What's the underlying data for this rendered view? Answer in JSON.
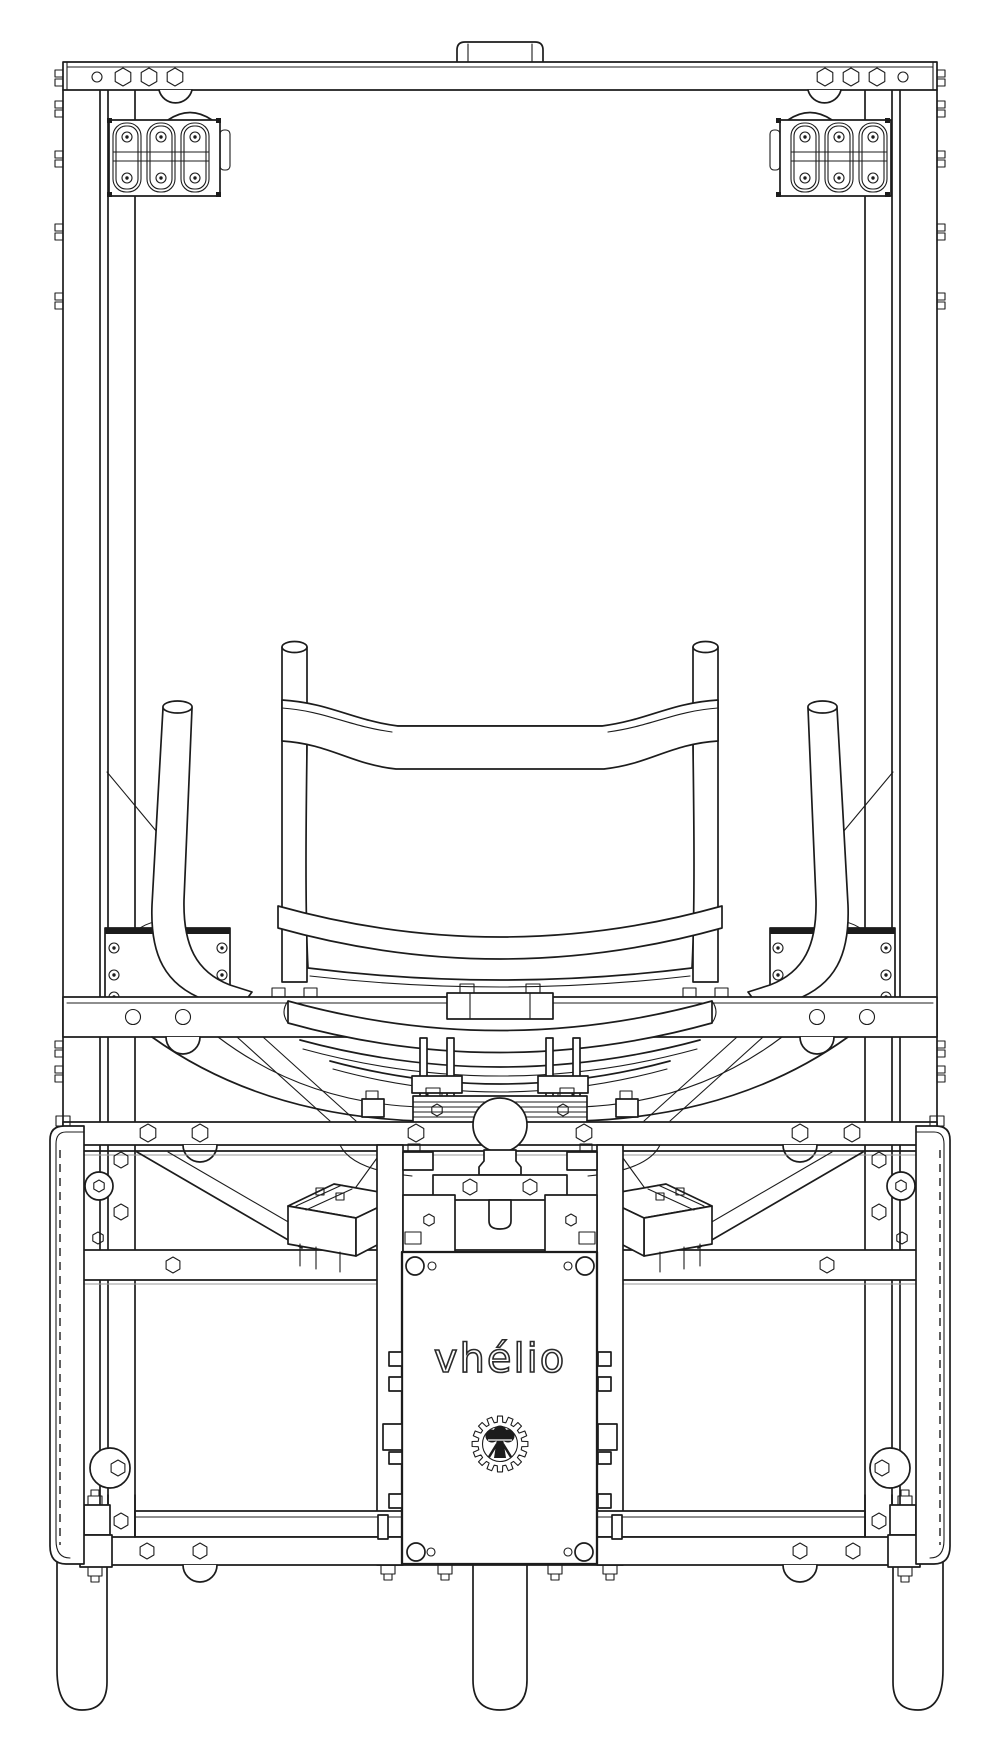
{
  "brand": {
    "name": "vhélio"
  },
  "logo": {
    "name": "gear-tree-logo"
  },
  "drawing": {
    "kind": "engineering line drawing",
    "view": "front elevation of vhélio solar cargo cycle",
    "colors": {
      "line": "#1c1c1c",
      "background": "#ffffff",
      "faint_line": "#9a9a9a"
    }
  }
}
